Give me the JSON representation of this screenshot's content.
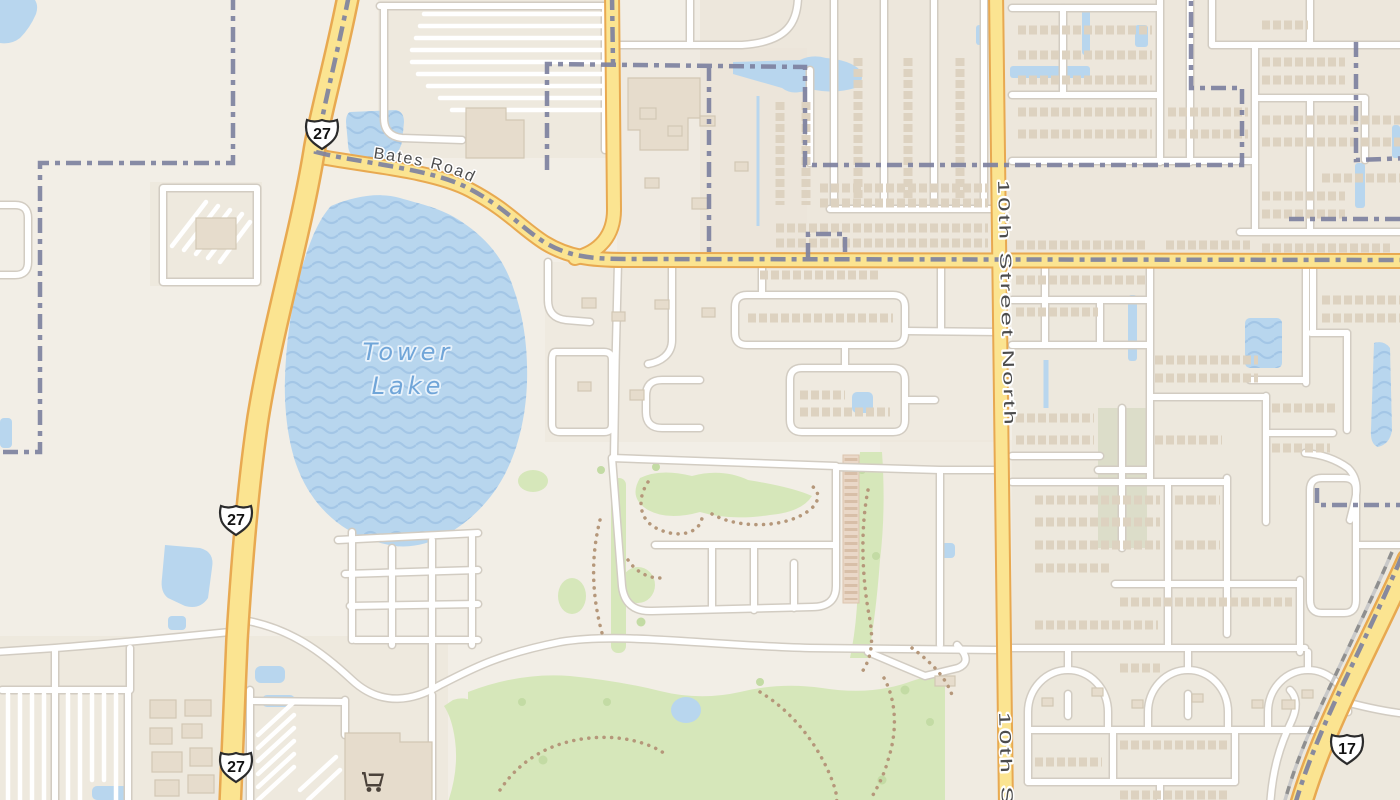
{
  "map": {
    "type": "street-map",
    "labels": {
      "bates_road": "Bates Road",
      "tower_lake_line1": "Tower",
      "tower_lake_line2": "Lake",
      "tenth_street_north": "10th Street North",
      "tenth_street_partial": "10th Str"
    },
    "shields": [
      {
        "system": "US Route",
        "route": "27"
      },
      {
        "system": "US Route",
        "route": "27"
      },
      {
        "system": "US Route",
        "route": "27"
      },
      {
        "system": "US Route",
        "route": "17"
      }
    ],
    "poi": [
      {
        "type": "supermarket",
        "icon": "shopping-cart"
      }
    ],
    "colors": {
      "background": "#f2eee6",
      "residential": "#eae3d6",
      "water": "#b8d6ee",
      "waterWave": "#a3c6e6",
      "roadFill": "#fbe491",
      "roadCasing": "#e8a951",
      "minorCasing": "#d2ccc2",
      "boundary": "#7e82a0",
      "golf": "#d6e7ba",
      "tree": "#c3dba4",
      "building": "#ddd2c0",
      "buildingSolid": "#e6dccc",
      "label": "#4c4c4c",
      "waterLabel": "#70a5d8",
      "trail": "#b5977a"
    }
  }
}
